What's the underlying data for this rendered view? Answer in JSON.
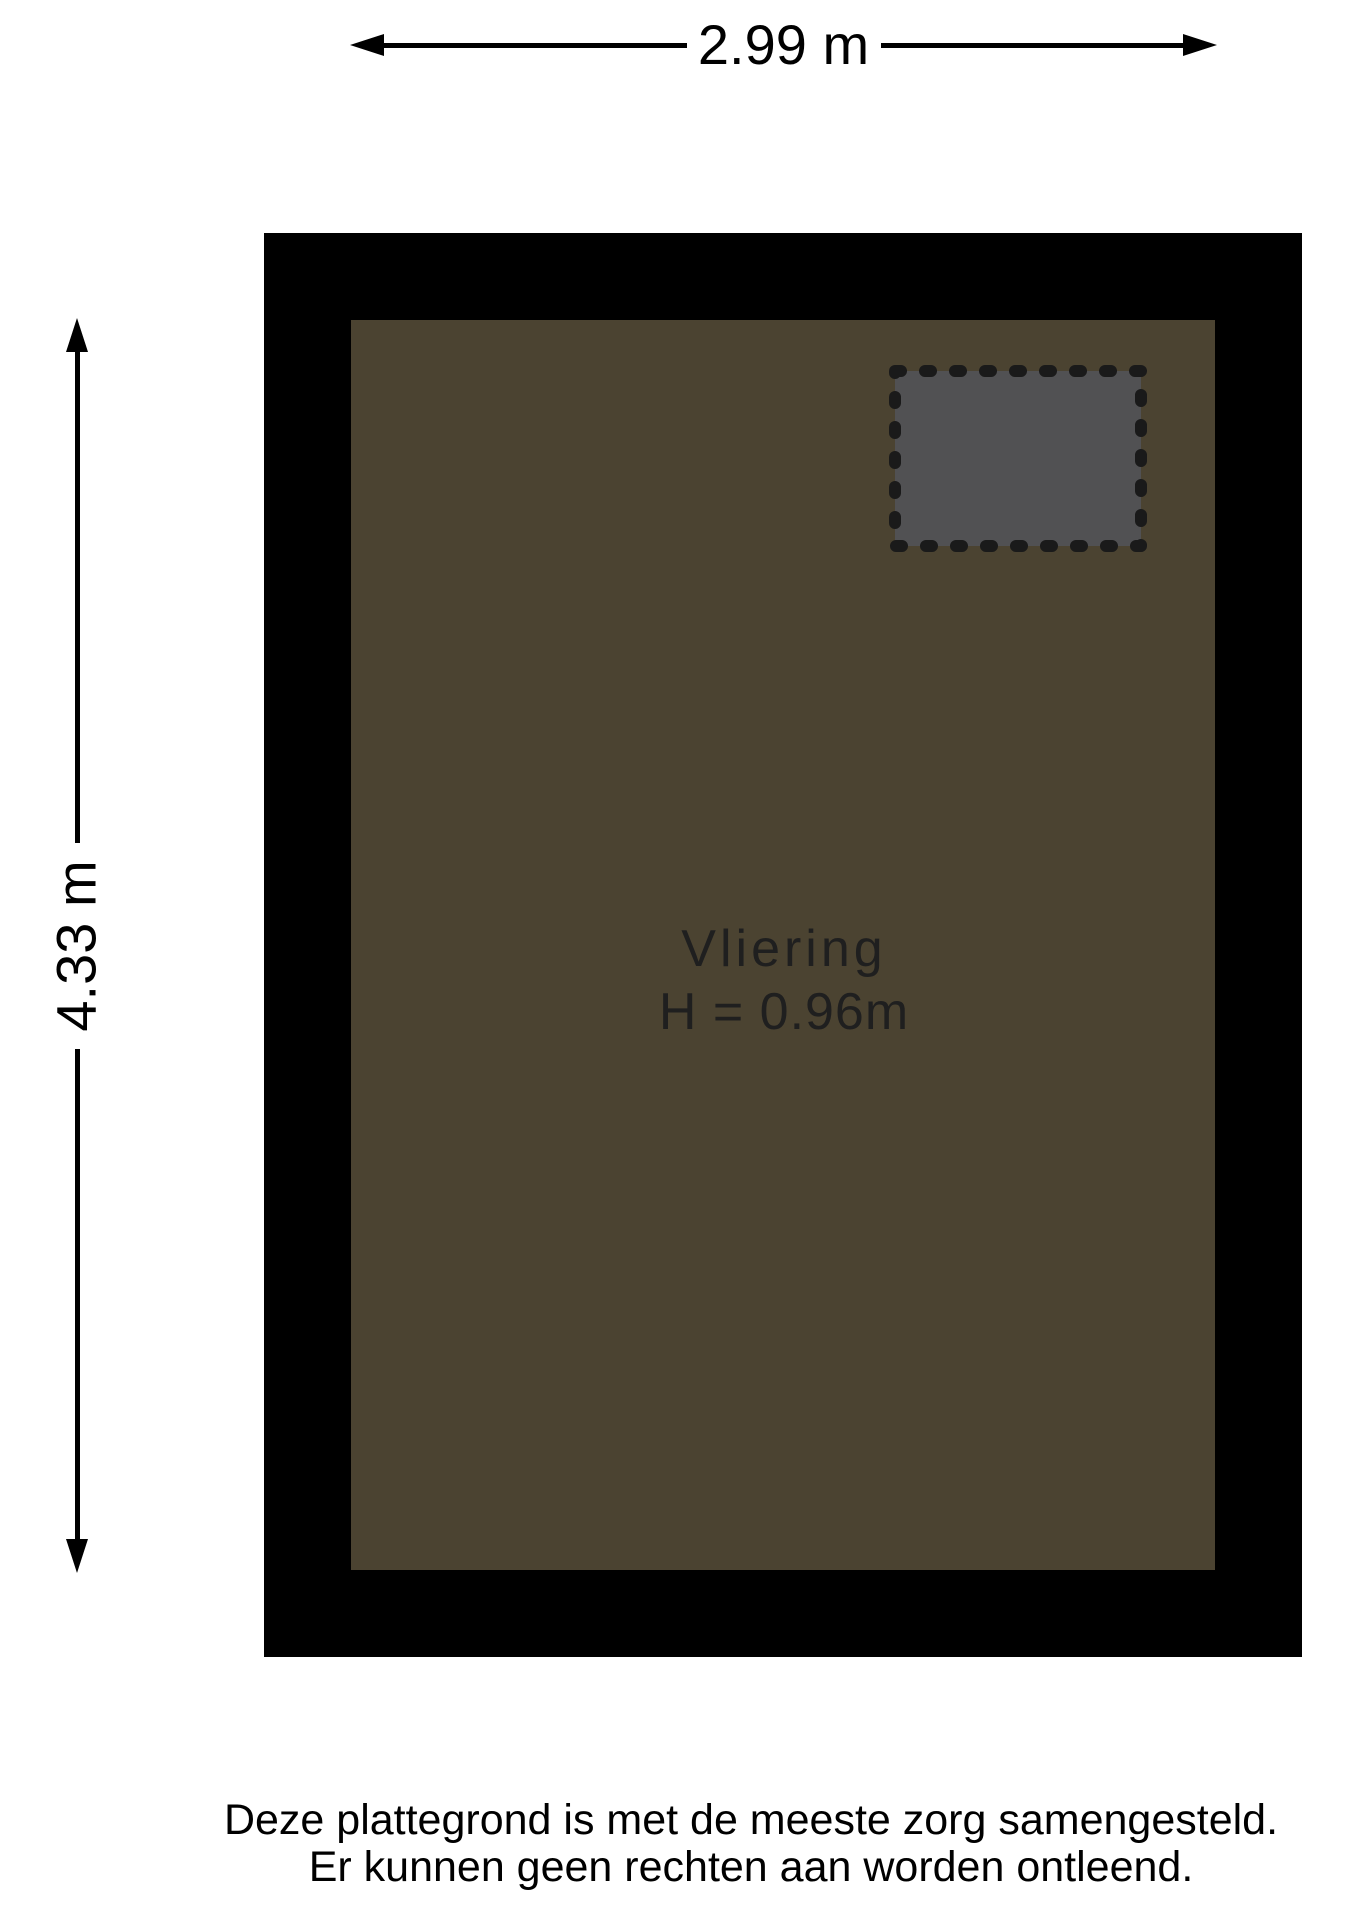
{
  "dimensions": {
    "width_label": "2.99 m",
    "height_label": "4.33 m"
  },
  "room": {
    "name": "Vliering",
    "height_label": "H = 0.96m"
  },
  "footer": {
    "line1": "Deze plattegrond is met de meeste zorg samengesteld.",
    "line2": "Er kunnen geen rechten aan worden ontleend."
  },
  "colors": {
    "wall": "#000000",
    "floor": "#4b4331",
    "hatch_fill": "#515153",
    "hatch_border": "#1a1a1a",
    "label_text": "#1f1f1f",
    "dim_text": "#000000"
  }
}
